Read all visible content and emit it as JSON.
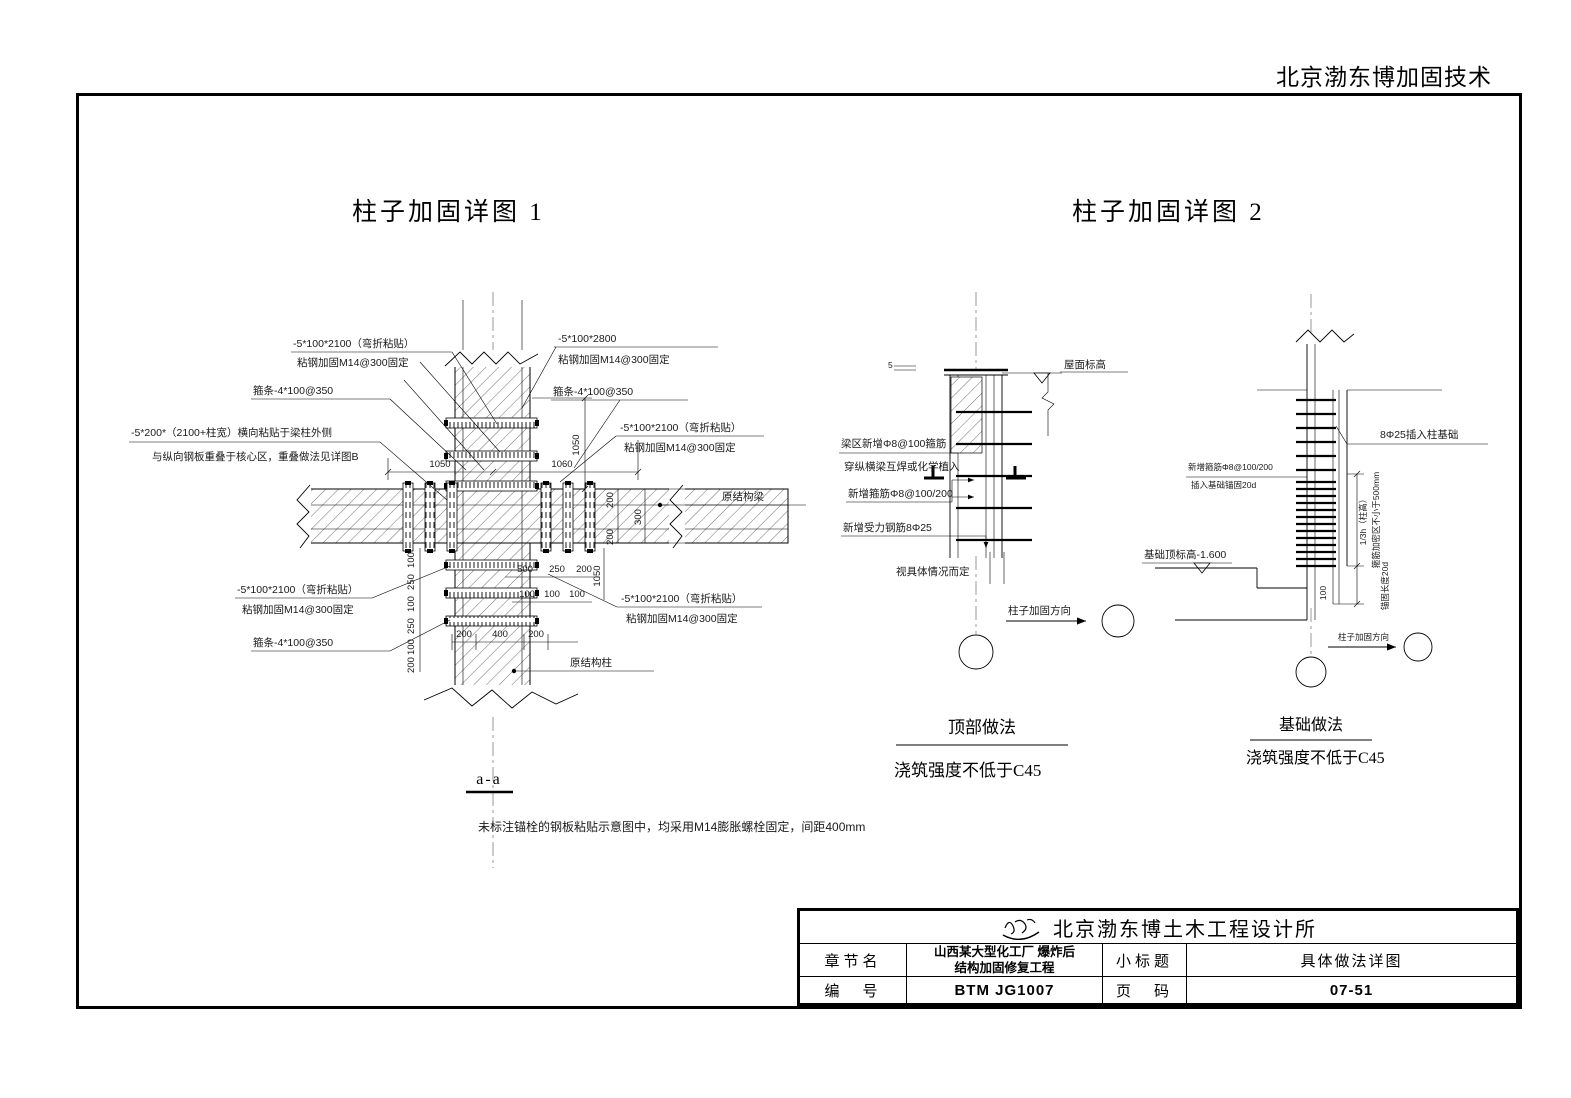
{
  "header": {
    "company_short": "北京渤东博加固技术"
  },
  "d1": {
    "title": "柱子加固详图 1",
    "ann": {
      "tl1a": "-5*100*2100（弯折粘贴）",
      "tl1b": "粘钢加固M14@300固定",
      "tl2": "箍条-4*100@350",
      "tl3a": "-5*200*（2100+柱宽）横向粘贴于梁柱外侧",
      "tl3b": "与纵向钢板重叠于核心区，重叠做法见详图B",
      "tr1a": "-5*100*2800",
      "tr1b": "粘钢加固M14@300固定",
      "tr2": "箍条-4*100@350",
      "tr3a": "-5*100*2100（弯折粘贴）",
      "tr3b": "粘钢加固M14@300固定",
      "beam": "原结构梁",
      "bl1a": "-5*100*2100（弯折粘贴）",
      "bl1b": "粘钢加固M14@300固定",
      "bl2": "箍条-4*100@350",
      "br1a": "-5*100*2100（弯折粘贴）",
      "br1b": "粘钢加固M14@300固定",
      "column": "原结构柱"
    },
    "dim": {
      "w_left": "1050",
      "w_right": "1060",
      "h_top": "1050",
      "h_bottom": "1050",
      "beam": [
        "200",
        "300",
        "200"
      ],
      "col_bottom": [
        "200",
        "400",
        "200"
      ],
      "left_stack": [
        "100",
        "250",
        "100",
        "250",
        "100",
        "200"
      ],
      "right_row1": [
        "500",
        "250",
        "200"
      ],
      "right_row2": [
        "100",
        "100",
        "100"
      ]
    },
    "section": "a-a",
    "note": "未标注锚栓的钢板粘贴示意图中，均采用M14膨胀螺栓固定，间距400mm"
  },
  "d2": {
    "title": "柱子加固详图 2",
    "top": {
      "roof": "屋面标高",
      "plate5": "5",
      "a1a": "梁区新增Φ8@100箍筋",
      "a1b": "穿纵横梁互焊或化学植入",
      "a2": "新增箍筋Φ8@100/200",
      "a3": "新增受力钢筋8Φ25",
      "form": "视具体情况而定",
      "dir": "柱子加固方向",
      "caption": "顶部做法",
      "strength": "浇筑强度不低于C45"
    },
    "base": {
      "a1": "8Φ25插入柱基础",
      "a2a": "新增箍筋Φ8@100/200",
      "a2b": "插入基础锚固20d",
      "level": "基础顶标高-1.600",
      "h3": "1/3h（柱高）",
      "dense": "箍筋加密区不小于500mm",
      "anchor": "锚固长度20d",
      "d100": "100",
      "dir": "柱子加固方向",
      "caption": "基础做法",
      "strength": "浇筑强度不低于C45"
    }
  },
  "tb": {
    "company": "北京渤东博土木工程设计所",
    "chapter_label": "章节名",
    "project1": "山西某大型化工厂 爆炸后",
    "project2": "结构加固修复工程",
    "subtitle_label": "小标题",
    "subtitle": "具体做法详图",
    "code_label": "编　号",
    "code": "BTM JG1007",
    "page_label": "页　码",
    "page": "07-51"
  }
}
